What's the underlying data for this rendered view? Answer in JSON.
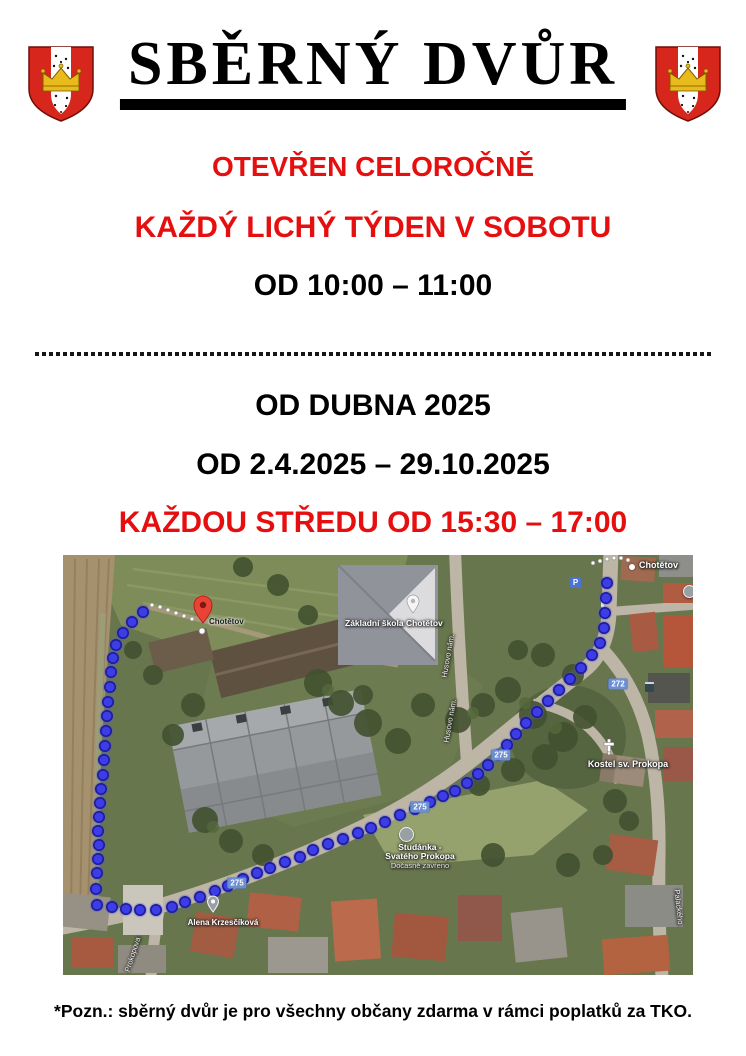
{
  "header": {
    "title": "SBĚRNÝ DVŮR"
  },
  "schedule": {
    "open_all_year": "OTEVŘEN CELOROČNĚ",
    "odd_week_saturday": "KAŽDÝ LICHÝ TÝDEN V SOBOTU",
    "saturday_hours": "OD 10:00 – 11:00",
    "from_april": "OD DUBNA 2025",
    "date_range": "OD 2.4.2025 – 29.10.2025",
    "wednesday_hours": "KAŽDOU STŘEDU OD 15:30 – 17:00"
  },
  "footer": {
    "note": "*Pozn.: sběrný dvůr je pro všechny občany zdarma v rámci poplatků za TKO."
  },
  "colors": {
    "accent_red": "#e60f0f",
    "route_blue": "#3d3de8",
    "route_blue_edge": "#1c1c96",
    "shield_blue": "#6c8ed2"
  },
  "map": {
    "labels": {
      "pin_place": "Chotětov",
      "town": "Chotětov",
      "school": "Základní škola Chotětov",
      "church": "Kostel sv. Prokopa",
      "well_line1": "Studánka -",
      "well_line2": "Svatého Prokopa",
      "well_status": "Dočasně zavřeno",
      "person_poi": "Alena Krzesčíková",
      "street_husovo_a": "Husovo nám.",
      "street_husovo_b": "Husovo nám.",
      "street_prokopova": "Prokopova",
      "street_palackeho": "Palackého",
      "parking": "P"
    },
    "shields": [
      {
        "label": "272",
        "x": 555,
        "y": 129
      },
      {
        "label": "275",
        "x": 438,
        "y": 200
      },
      {
        "label": "275",
        "x": 357,
        "y": 252
      },
      {
        "label": "275",
        "x": 174,
        "y": 328
      }
    ],
    "route_points": [
      [
        544,
        28
      ],
      [
        543,
        43
      ],
      [
        542,
        58
      ],
      [
        541,
        73
      ],
      [
        537,
        88
      ],
      [
        529,
        100
      ],
      [
        518,
        113
      ],
      [
        507,
        124
      ],
      [
        496,
        135
      ],
      [
        485,
        146
      ],
      [
        474,
        157
      ],
      [
        463,
        168
      ],
      [
        453,
        179
      ],
      [
        444,
        190
      ],
      [
        435,
        200
      ],
      [
        425,
        210
      ],
      [
        415,
        219
      ],
      [
        404,
        228
      ],
      [
        392,
        236
      ],
      [
        380,
        241
      ],
      [
        367,
        247
      ],
      [
        352,
        254
      ],
      [
        337,
        260
      ],
      [
        322,
        267
      ],
      [
        308,
        273
      ],
      [
        295,
        278
      ],
      [
        280,
        284
      ],
      [
        265,
        289
      ],
      [
        250,
        295
      ],
      [
        237,
        302
      ],
      [
        222,
        307
      ],
      [
        207,
        313
      ],
      [
        194,
        318
      ],
      [
        180,
        324
      ],
      [
        165,
        331
      ],
      [
        152,
        336
      ],
      [
        137,
        342
      ],
      [
        122,
        347
      ],
      [
        109,
        352
      ],
      [
        93,
        355
      ],
      [
        77,
        355
      ],
      [
        63,
        354
      ],
      [
        49,
        352
      ],
      [
        34,
        350
      ],
      [
        33,
        334
      ],
      [
        34,
        318
      ],
      [
        35,
        304
      ],
      [
        36,
        290
      ],
      [
        35,
        276
      ],
      [
        36,
        262
      ],
      [
        37,
        248
      ],
      [
        38,
        234
      ],
      [
        40,
        220
      ],
      [
        41,
        205
      ],
      [
        42,
        191
      ],
      [
        43,
        176
      ],
      [
        44,
        161
      ],
      [
        45,
        147
      ],
      [
        47,
        132
      ],
      [
        48,
        117
      ],
      [
        50,
        103
      ],
      [
        53,
        90
      ],
      [
        60,
        78
      ],
      [
        69,
        67
      ],
      [
        80,
        57
      ]
    ],
    "trails": [
      [
        [
          530,
          8
        ],
        [
          537,
          6
        ],
        [
          544,
          4
        ],
        [
          551,
          3
        ],
        [
          558,
          3
        ],
        [
          565,
          5
        ]
      ],
      [
        [
          89,
          50
        ],
        [
          97,
          52
        ],
        [
          105,
          55
        ],
        [
          113,
          58
        ],
        [
          121,
          61
        ],
        [
          129,
          64
        ]
      ]
    ]
  }
}
